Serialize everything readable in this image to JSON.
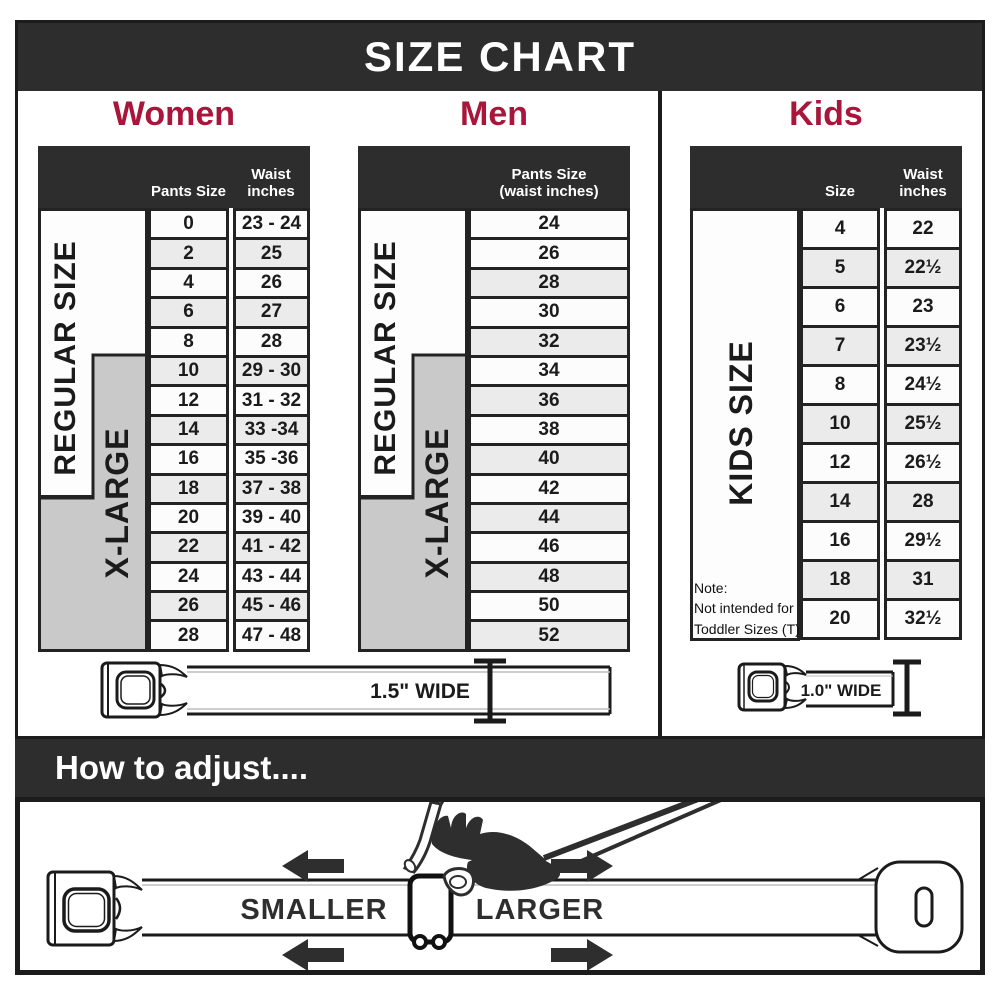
{
  "title": "SIZE CHART",
  "chart_data": [
    {
      "type": "table",
      "title": "Women",
      "columns": [
        "Pants Size",
        "Waist inches"
      ],
      "rows": [
        [
          "0",
          "23 - 24"
        ],
        [
          "2",
          "25"
        ],
        [
          "4",
          "26"
        ],
        [
          "6",
          "27"
        ],
        [
          "8",
          "28"
        ],
        [
          "10",
          "29 - 30"
        ],
        [
          "12",
          "31 - 32"
        ],
        [
          "14",
          "33 -34"
        ],
        [
          "16",
          "35 -36"
        ],
        [
          "18",
          "37 - 38"
        ],
        [
          "20",
          "39 - 40"
        ],
        [
          "22",
          "41 - 42"
        ],
        [
          "24",
          "43 - 44"
        ],
        [
          "26",
          "45 - 46"
        ],
        [
          "28",
          "47 - 48"
        ]
      ]
    },
    {
      "type": "table",
      "title": "Men",
      "columns": [
        "Pants Size (waist inches)"
      ],
      "rows": [
        [
          "24"
        ],
        [
          "26"
        ],
        [
          "28"
        ],
        [
          "30"
        ],
        [
          "32"
        ],
        [
          "34"
        ],
        [
          "36"
        ],
        [
          "38"
        ],
        [
          "40"
        ],
        [
          "42"
        ],
        [
          "44"
        ],
        [
          "46"
        ],
        [
          "48"
        ],
        [
          "50"
        ],
        [
          "52"
        ]
      ]
    },
    {
      "type": "table",
      "title": "Kids",
      "columns": [
        "Size",
        "Waist inches"
      ],
      "rows": [
        [
          "4",
          "22"
        ],
        [
          "5",
          "22½"
        ],
        [
          "6",
          "23"
        ],
        [
          "7",
          "23½"
        ],
        [
          "8",
          "24½"
        ],
        [
          "10",
          "25½"
        ],
        [
          "12",
          "26½"
        ],
        [
          "14",
          "28"
        ],
        [
          "16",
          "29½"
        ],
        [
          "18",
          "31"
        ],
        [
          "20",
          "32½"
        ]
      ]
    }
  ],
  "display": {
    "women_col_lines": [
      [
        "Pants Size"
      ],
      [
        "Waist",
        "inches"
      ]
    ],
    "men_col_lines": [
      [
        "Pants Size",
        "(waist inches)"
      ]
    ],
    "kids_col_lines": [
      [
        "Size"
      ],
      [
        "Waist",
        "inches"
      ]
    ],
    "regular_label": "REGULAR SIZE",
    "xlarge_label": "X-LARGE",
    "kids_side_label": "KIDS SIZE",
    "kids_note_lines": [
      "Note:",
      "Not intended for",
      "Toddler Sizes (T)"
    ],
    "adult_belt_width": "1.5\" WIDE",
    "kids_belt_width": "1.0\" WIDE"
  },
  "adjust": {
    "heading": "How to adjust....",
    "smaller_label": "SMALLER",
    "larger_label": "LARGER"
  },
  "colors": {
    "accent_red": "#a8163c",
    "band_dark": "#2d2d2d",
    "xlarge_gray": "#c9c9c9",
    "stripe_gray": "#ebebeb"
  }
}
